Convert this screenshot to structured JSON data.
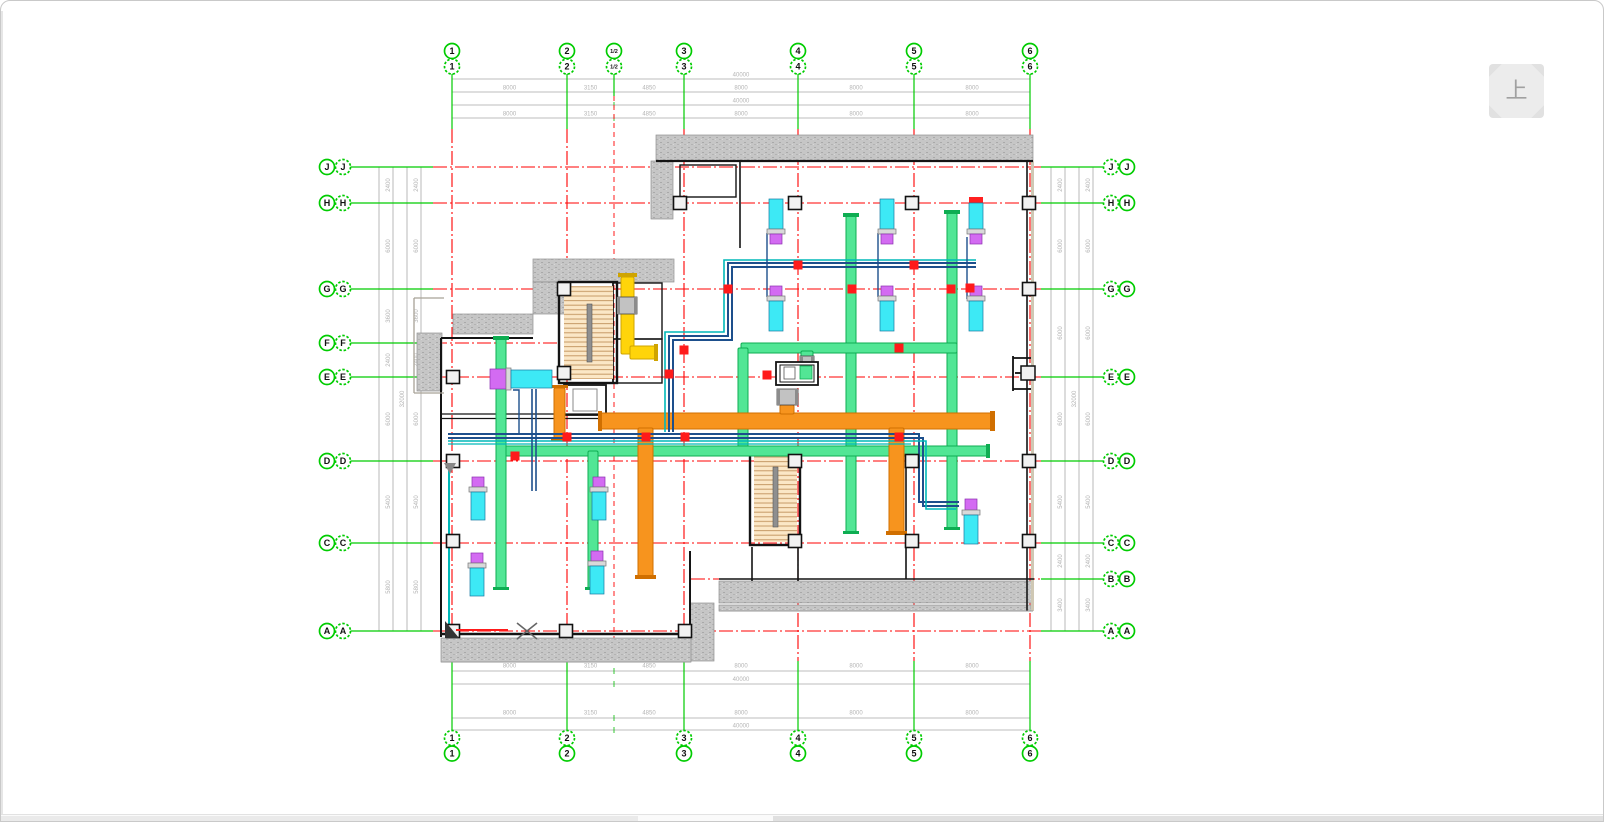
{
  "window": {
    "up_button_label": "上"
  },
  "axes": {
    "top_columns": [
      "1",
      "2",
      "1/2",
      "3",
      "4",
      "5",
      "6"
    ],
    "bottom_columns": [
      "1",
      "2",
      "3",
      "4",
      "5",
      "6"
    ],
    "left_rows": [
      "J",
      "H",
      "G",
      "F",
      "E",
      "D",
      "C",
      "A"
    ],
    "right_rows": [
      "J",
      "H",
      "G",
      "E",
      "D",
      "C",
      "B",
      "A"
    ]
  },
  "dimensions": {
    "top": {
      "segments": [
        "8000",
        "3150",
        "4850",
        "8000",
        "8000",
        "8000"
      ],
      "total": "40000"
    },
    "bottom": {
      "segments": [
        "8000",
        "3150",
        "4850",
        "8000",
        "8000",
        "8000"
      ],
      "total": "40000"
    },
    "left": {
      "segments": [
        "2400",
        "6000",
        "3600",
        "2400",
        "6000",
        "5400",
        "5800"
      ],
      "total": "32000"
    },
    "right": {
      "segments": [
        "2400",
        "6000",
        "6000",
        "6000",
        "5400",
        "2400",
        "3400"
      ],
      "total": "32000"
    }
  },
  "colors": {
    "axis_green": "#00cc00",
    "grid_red": "#ff0000",
    "duct_green": "#52e695",
    "duct_orange": "#f7941e",
    "duct_yellow": "#ffd40a",
    "pipe_navy": "#1d4f8c",
    "pipe_teal": "#00b9b9",
    "unit_cyan": "#3de9f5",
    "unit_magenta": "#d36bf2",
    "wall_hatch": "#c6c6c6",
    "stair_fill": "#fbe7c6"
  }
}
